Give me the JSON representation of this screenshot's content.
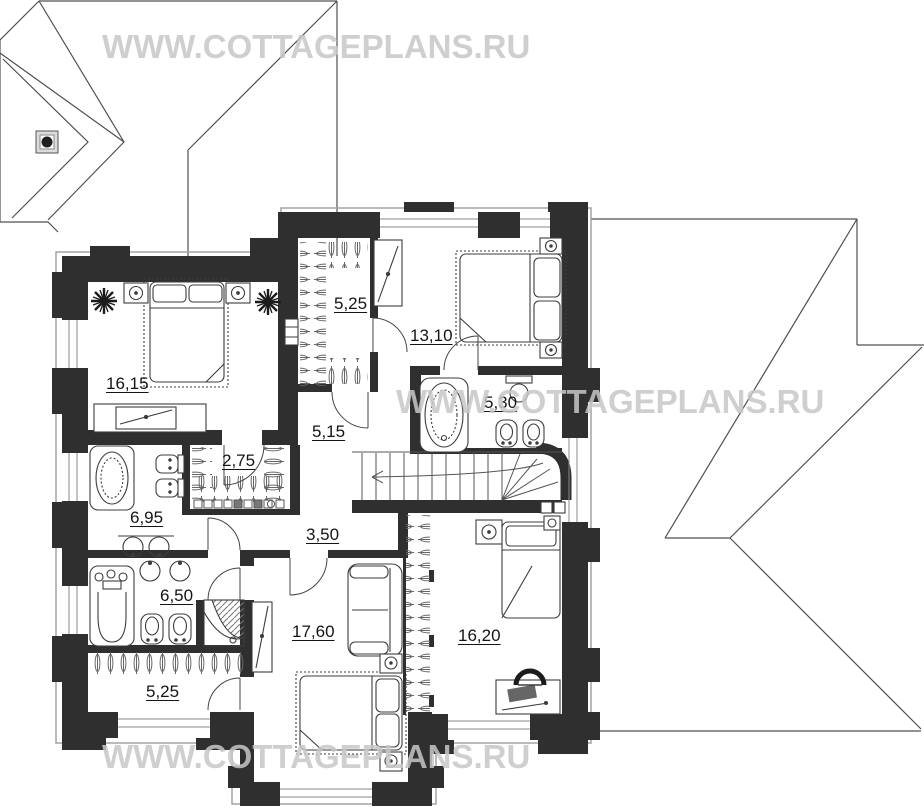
{
  "watermark": {
    "text": "WWW.COTTAGEPLANS.RU",
    "color": "#c7c7c7"
  },
  "rooms": [
    {
      "name": "bedroom-top-left",
      "area": "16,15"
    },
    {
      "name": "closet-top",
      "area": "5,25"
    },
    {
      "name": "bedroom-top-right",
      "area": "13,10"
    },
    {
      "name": "hall-upper",
      "area": "5,15"
    },
    {
      "name": "bathroom-top",
      "area": "5,30"
    },
    {
      "name": "closet-middle",
      "area": "2,75"
    },
    {
      "name": "bathroom-middle",
      "area": "6,95"
    },
    {
      "name": "hall-lower",
      "area": "3,50"
    },
    {
      "name": "bathroom-bottom",
      "area": "6,50"
    },
    {
      "name": "bedroom-bottom-middle",
      "area": "17,60"
    },
    {
      "name": "bedroom-bottom-right",
      "area": "16,20"
    },
    {
      "name": "closet-bottom",
      "area": "5,25"
    }
  ],
  "colors": {
    "wall": "#2f2f2f",
    "roof_line": "#4f4f4f",
    "eave_line": "#a3a3a3",
    "furniture_line": "#3c3c3c",
    "label_text": "#141414"
  }
}
